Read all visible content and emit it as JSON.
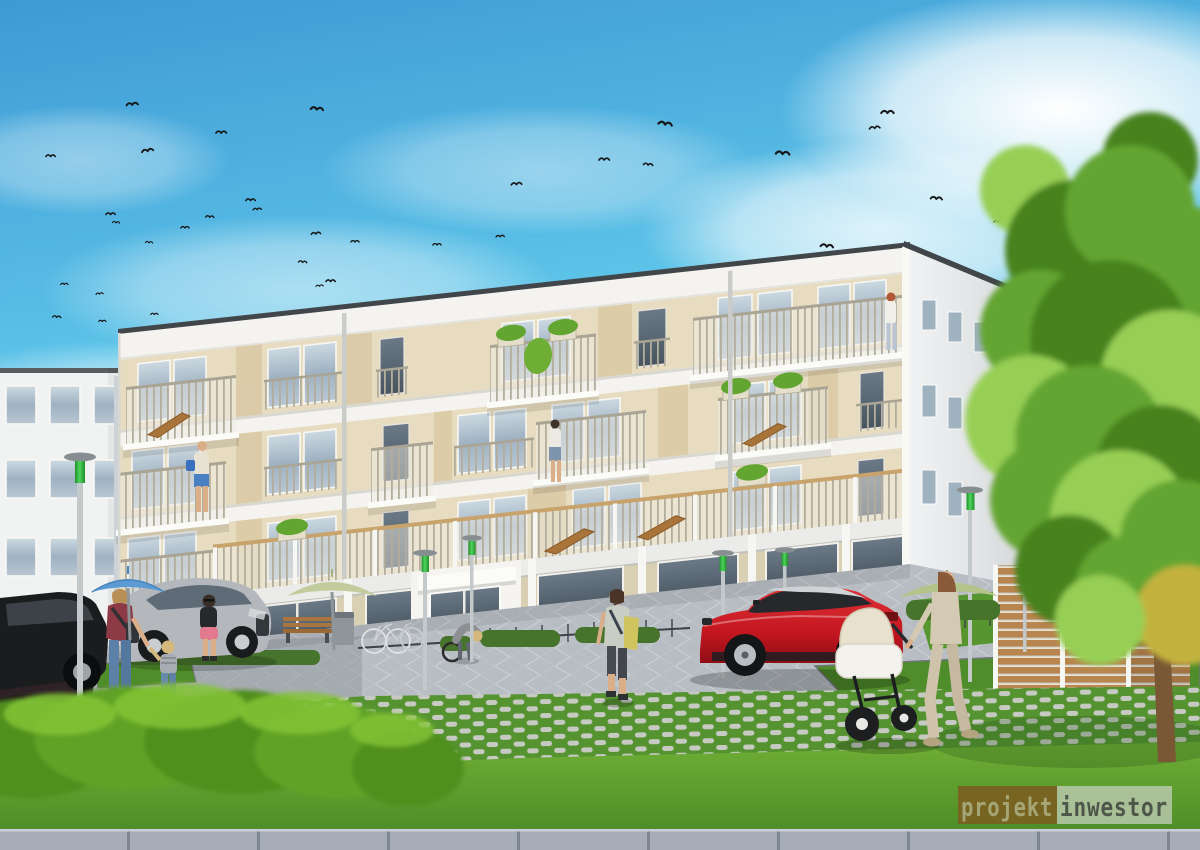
{
  "scene": {
    "type": "architectural exterior rendering",
    "description": "Modern four-storey residential building with balconies on a sunny day; landscaped courtyard with paved plaza, grass-grid pavers, hedge, large tree, parked cars, a red SUV, pedestrians, a woman with a stroller and a flock of birds in a blue sky",
    "birds": [
      [
        125,
        100,
        1.1,
        -5
      ],
      [
        310,
        103,
        1.2,
        5
      ],
      [
        215,
        128,
        1,
        0
      ],
      [
        140,
        147,
        1.1,
        -10
      ],
      [
        45,
        152,
        0.9,
        0
      ],
      [
        658,
        117,
        1.3,
        8
      ],
      [
        880,
        107,
        1.2,
        0
      ],
      [
        868,
        124,
        1,
        -6
      ],
      [
        775,
        147,
        1.3,
        4
      ],
      [
        598,
        155,
        1,
        0
      ],
      [
        643,
        160,
        0.9,
        6
      ],
      [
        510,
        180,
        1,
        -4
      ],
      [
        930,
        193,
        1.1,
        5
      ],
      [
        1062,
        192,
        1,
        0
      ],
      [
        1052,
        205,
        0.9,
        -5
      ],
      [
        993,
        218,
        0.8,
        0
      ],
      [
        820,
        240,
        1.2,
        6
      ],
      [
        245,
        196,
        0.9,
        0
      ],
      [
        252,
        206,
        0.8,
        -4
      ],
      [
        205,
        213,
        0.8,
        3
      ],
      [
        105,
        210,
        0.9,
        0
      ],
      [
        112,
        219,
        0.7,
        5
      ],
      [
        180,
        224,
        0.8,
        0
      ],
      [
        310,
        230,
        0.9,
        -5
      ],
      [
        350,
        238,
        0.8,
        0
      ],
      [
        145,
        239,
        0.7,
        4
      ],
      [
        432,
        241,
        0.8,
        0
      ],
      [
        495,
        233,
        0.8,
        -3
      ],
      [
        298,
        258,
        0.8,
        5
      ],
      [
        325,
        277,
        0.9,
        0
      ],
      [
        60,
        281,
        0.7,
        0
      ],
      [
        95,
        291,
        0.7,
        -5
      ],
      [
        52,
        313,
        0.8,
        4
      ],
      [
        98,
        318,
        0.7,
        0
      ],
      [
        150,
        311,
        0.7,
        0
      ],
      [
        315,
        283,
        0.7,
        -4
      ]
    ]
  },
  "watermark": {
    "left_text": "projekt",
    "right_text": "inwestor"
  },
  "colors": {
    "sky_top": "#3f9ad4",
    "sky_mid": "#5cc3e8",
    "sky_horizon": "#d8eef6",
    "facade_white": "#f4f3ef",
    "beige": "#e7dcbf",
    "beige_dark": "#d9c8a3",
    "slab": "#fafaf8",
    "roofline": "#41464a",
    "glass": "#a9bcc9",
    "railing_slat": "#b2ad9d",
    "handrail": "#c8a36c",
    "pave": "#b7bdc3",
    "curb": "#a6adb9",
    "grass": "#4e8c27",
    "grass_light": "#6fae35",
    "grid_green": "#559330",
    "grid_gray": "#c7cac3",
    "hedge": "#4f8f1d",
    "hedge_light": "#84c436",
    "tree": "#63a531",
    "tree_dark": "#47821f",
    "tree_light": "#97cf54",
    "trunk": "#7a5836",
    "wood": "#b9854e",
    "car_red": "#c4161f",
    "lamp_green": "#2eb43c",
    "skin": "#d9ae88",
    "wm_left_bg": "#7c5c20",
    "wm_left_text": "#a5a576",
    "wm_right_bg": "#becab3",
    "wm_right_text": "#4e564a"
  }
}
